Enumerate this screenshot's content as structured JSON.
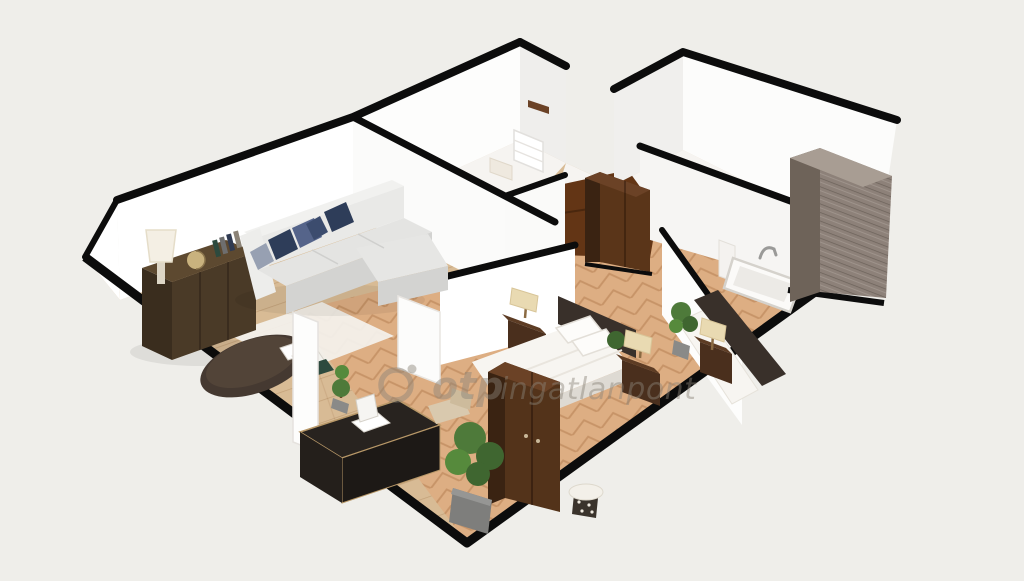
{
  "watermark": {
    "logo": "otp-ring-logo",
    "text_bold": "otp",
    "text_regular": "ingatlanpont",
    "opacity": 0.45
  },
  "scene": {
    "type": "3d-floorplan-render",
    "style": "dollhouse cutaway, oblique top-down view, white walls with black wall caps",
    "rooms": [
      {
        "name": "living-room",
        "floor": "light-wood-planks",
        "furniture": [
          "sectional-sofa-light-gray",
          "navy-and-gray-throw-pillows",
          "dark-brown-sideboard",
          "white-table-lamp",
          "globe",
          "books",
          "round-dark-coffee-table",
          "white-area-rug"
        ]
      },
      {
        "name": "kitchen-top-left-room",
        "floor": "pale",
        "furniture": [
          "brown-wall-shelf",
          "white-cabinet-with-drawers",
          "counter"
        ]
      },
      {
        "name": "top-right-room",
        "floor": "pale",
        "furniture": []
      },
      {
        "name": "middle-room",
        "floor": "dark-brown-wood",
        "furniture": [
          "dark-brown-wardrobe"
        ]
      },
      {
        "name": "bathroom",
        "floor": "pale",
        "furniture": [
          "bathtub",
          "chrome-faucet",
          "white-pedestal"
        ]
      },
      {
        "name": "master-bedroom",
        "floor": "herringbone-wood",
        "furniture": [
          "double-bed-white-linens",
          "dark-headboard",
          "nightstand-left",
          "nightstand-right",
          "cream-table-lamps",
          "tall-dark-wardrobe",
          "black-desk-with-papers",
          "beige-chair",
          "topiary-plant",
          "large-potted-plant",
          "patterned-stool",
          "white-door-panel"
        ]
      },
      {
        "name": "second-bedroom",
        "floor": "herringbone-wood",
        "furniture": [
          "bed-dark-headboard",
          "nightstand-with-lamp",
          "potted-plant"
        ]
      },
      {
        "name": "exterior-right",
        "floor": "none",
        "furniture": [
          "large-gray-wood-wardrobe"
        ]
      }
    ]
  },
  "colors": {
    "bg": "#efeeea",
    "line": "#0c0c0c",
    "wall": "#ffffff",
    "wallShade": "#efeeec",
    "floorLight": "#d8bb95",
    "floorWarm": "#ddae83",
    "floorPale": "#f6f4f1",
    "floorDark": "#633515",
    "sofa": "#e4e4e2",
    "sofaDark": "#d3d3d1",
    "navy": "#2e3d59",
    "navyLight": "#55648a",
    "pillowGray": "#97a0b2",
    "woodDark": "#4a3a27",
    "woodSide": "#3a2d1e",
    "woodTop": "#5d4930",
    "wardrobeFront": "#53331a",
    "wardrobeSide": "#3a2312",
    "wardrobeTop": "#6b4226",
    "nightstand": "#4a2f1d",
    "lampShade": "#e9dab2",
    "bedWhite": "#f7f5f1",
    "bedShadow": "#dedad3",
    "headboard": "#39302a",
    "deskTop": "#28231f",
    "deskSide": "#1d1916",
    "deskTrim": "#b89868",
    "plant": "#4e7a3a",
    "plantDark": "#3f6630",
    "pot": "#8a8a88",
    "potDark": "#6f6f6d",
    "grayWood": "#8d8179",
    "grayWoodSide": "#6e6359",
    "grayWoodTop": "#a89d93",
    "tub": "#fbfaf8",
    "tubEdge": "#d5d2cc",
    "chair": "#d9c9ae",
    "rug": "#f4f2ee",
    "watermark": "#8a8378"
  }
}
